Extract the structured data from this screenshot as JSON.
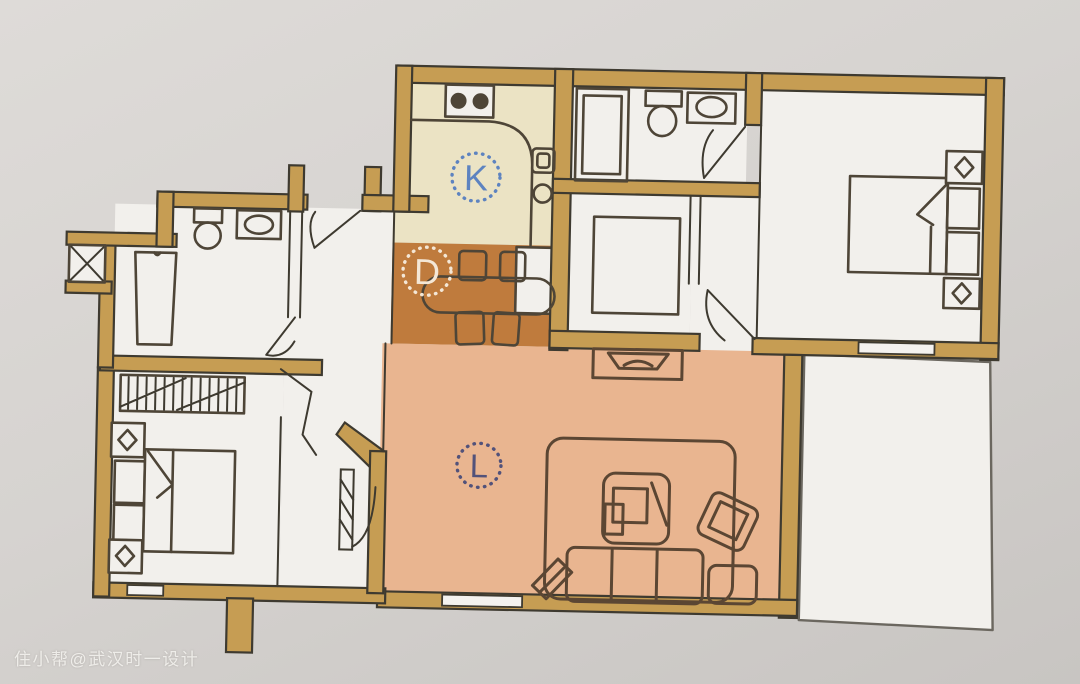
{
  "watermark": {
    "text": "住小帮@武汉时一设计"
  },
  "zones": {
    "kitchen": {
      "label": "K",
      "floor_color": "#ebe3c4",
      "label_color": "#5d83c0"
    },
    "dining": {
      "label": "D",
      "floor_color": "#bf7b3d",
      "label_color": "#f4e7d6"
    },
    "living": {
      "label": "L",
      "floor_color": "#e9b590",
      "label_color": "#52527a"
    }
  },
  "palette": {
    "background_top": "#dedbd8",
    "background_bottom": "#c8c5c2",
    "wall_fill": "#c69d53",
    "wall_outline": "#3e3a30",
    "room_floor": "#f2f0ec",
    "window_fill": "#f4f2ef",
    "furniture_line": "#4e4537",
    "living_furniture_line": "#5b4633",
    "balcony_line": "#6b675f"
  }
}
